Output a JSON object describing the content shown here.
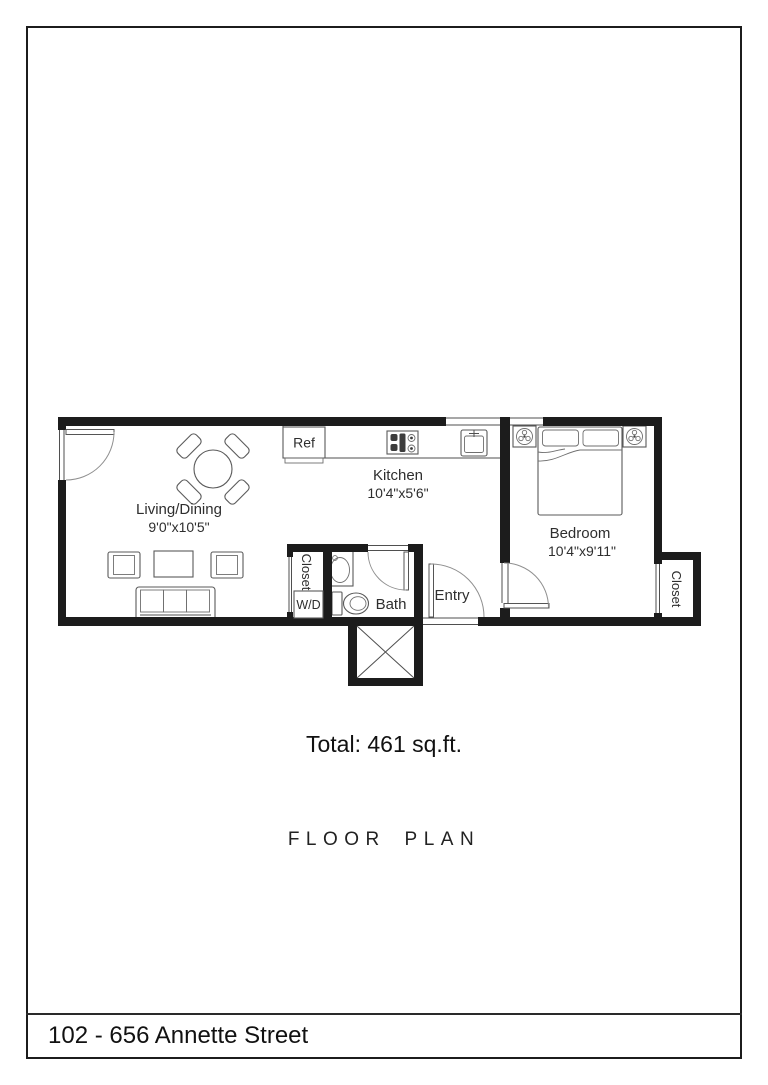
{
  "title_block": {
    "total": "Total: 461 sq.ft.",
    "plan_title": "FLOOR PLAN",
    "footer_address": "102 - 656 Annette Street"
  },
  "colors": {
    "wall": "#1c1c1c",
    "text": "#2e2e2e",
    "bg": "#ffffff"
  },
  "floor_plan": {
    "rooms": {
      "living_dining": {
        "name": "Living/Dining",
        "dimensions": "9'0\"x10'5\""
      },
      "kitchen": {
        "name": "Kitchen",
        "dimensions": "10'4\"x5'6\""
      },
      "bedroom": {
        "name": "Bedroom",
        "dimensions": "10'4\"x9'11\""
      },
      "bath": {
        "name": "Bath"
      },
      "entry": {
        "name": "Entry"
      },
      "hall_closet": {
        "name": "Closet"
      },
      "bedroom_closet": {
        "name": "Closet"
      }
    },
    "fixtures": {
      "refrigerator": "Ref",
      "washer_dryer": "W/D"
    }
  }
}
